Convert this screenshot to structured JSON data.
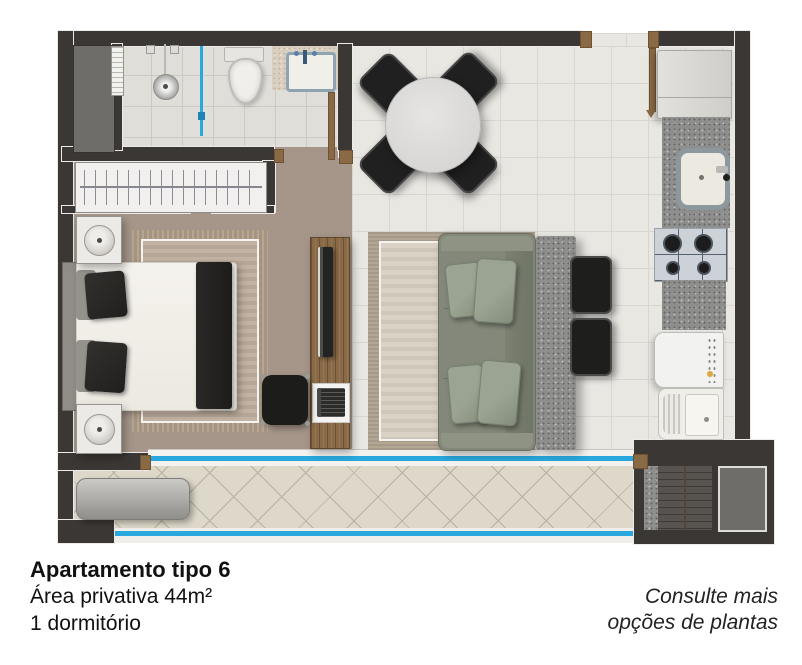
{
  "caption": {
    "title": "Apartamento tipo 6",
    "area": "Área privativa  44m²",
    "bedrooms": "1 dormitório"
  },
  "note": {
    "line1": "Consulte mais",
    "line2": "opções de plantas"
  },
  "colors": {
    "wall": "#3b3734",
    "glass_blue": "#29a8dd",
    "wood_floor": "#a6968a",
    "wood_furniture": "#8a6a46",
    "sofa": "#83887a",
    "granite": "#8e8e8c",
    "living_tile": "#e9e7e2",
    "bath_tile": "#e0ded8",
    "balcony_tile": "#ddd8ca"
  }
}
